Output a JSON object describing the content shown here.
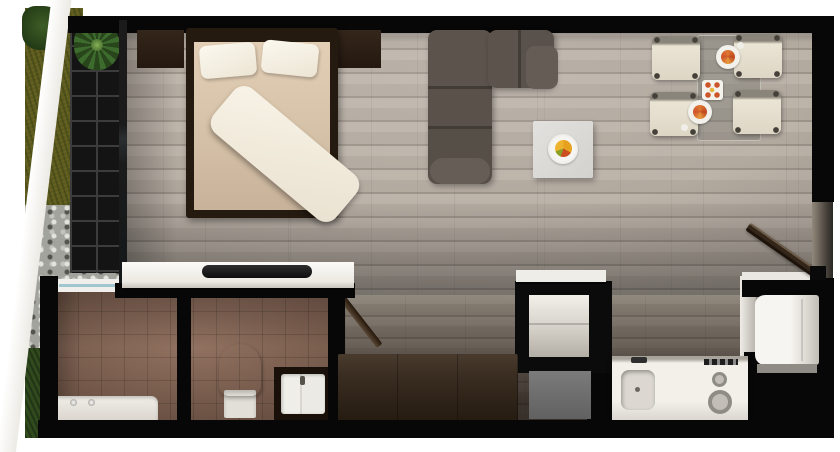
{
  "scene": {
    "type": "apartment-floor-plan-3d-render-top-view",
    "rooms": [
      {
        "name": "bedroom",
        "furniture": [
          "double-bed",
          "pillow",
          "pillow",
          "duvet",
          "nightstand-left",
          "nightstand-right",
          "desk-with-tray"
        ]
      },
      {
        "name": "living-room",
        "furniture": [
          "l-shaped-sofa",
          "coffee-table",
          "fruit-bowl"
        ]
      },
      {
        "name": "dining-area",
        "furniture": [
          "glass-dining-table",
          "dining-chair-top-left",
          "dining-chair-top-right",
          "dining-chair-bottom-left",
          "dining-chair-bottom-right",
          "plate-with-food",
          "plate-with-food",
          "centerpiece"
        ]
      },
      {
        "name": "kitchen",
        "furniture": [
          "counter",
          "sink",
          "faucet",
          "cooktop-burner-small",
          "cooktop-burner-large",
          "control-knobs",
          "refrigerator",
          "storage-niche",
          "gray-appliance"
        ]
      },
      {
        "name": "bathroom",
        "furniture": [
          "bathtub",
          "tub-taps",
          "toilet",
          "vanity",
          "basin",
          "window",
          "open-door",
          "partition-wall"
        ]
      },
      {
        "name": "hallway",
        "furniture": [
          "wardrobe"
        ]
      },
      {
        "name": "entry",
        "furniture": [
          "open-entry-door"
        ]
      },
      {
        "name": "exterior",
        "features": [
          "grass-lawn",
          "bush",
          "gravel-bed",
          "white-path",
          "balcony-deck-grid",
          "potted-plant"
        ]
      }
    ],
    "palette": {
      "wall": "#070707",
      "wood_floor": "#b2a99f",
      "bathroom_tile": "#7f5e4c",
      "sofa": "#5a524b",
      "bed_frame": "#241a10",
      "bedding": "#f8f3e7",
      "mattress": "#d5c0a5",
      "chair_cream": "#eae4d4",
      "counter_white": "#f3f0ea",
      "wardrobe_wood": "#3a2d21",
      "grass": "#5e5b1e",
      "grass_dark": "#2f4a1d",
      "gravel": "#a3a39d",
      "balcony_deck": "#141414",
      "fruit_accent": "#e8a21a",
      "food_accent": "#cf5527",
      "window_glass": "#9fc6d2"
    }
  }
}
